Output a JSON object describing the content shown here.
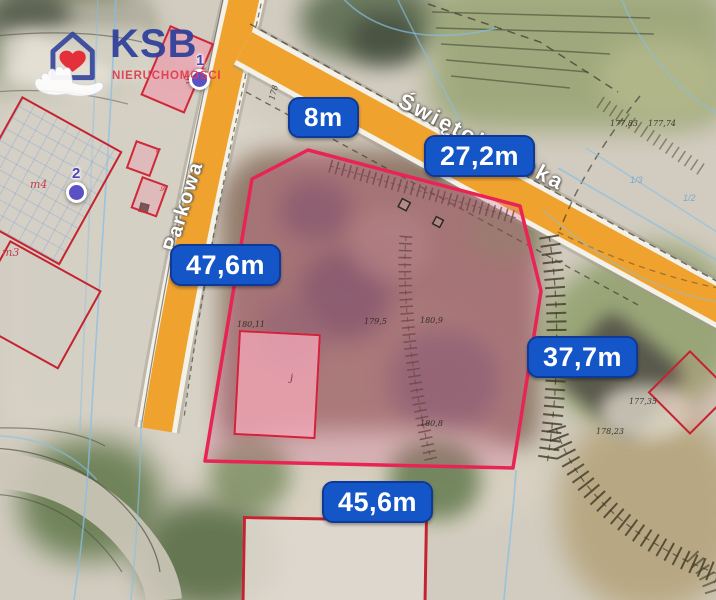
{
  "logo": {
    "brand": "KSB",
    "subtitle": "NIERUCHOMOŚCI"
  },
  "streets": {
    "left": "Parkowa",
    "top": "Świętokrzyska"
  },
  "measurements": [
    {
      "id": "north-west",
      "label": "8m"
    },
    {
      "id": "north",
      "label": "27,2m"
    },
    {
      "id": "west",
      "label": "47,6m"
    },
    {
      "id": "east",
      "label": "37,7m"
    },
    {
      "id": "south",
      "label": "45,6m"
    }
  ],
  "markers": [
    {
      "number": "1"
    },
    {
      "number": "2"
    }
  ],
  "parcel_labels": [
    {
      "text": "m"
    },
    {
      "text": "8"
    },
    {
      "text": "9"
    },
    {
      "text": "m4"
    },
    {
      "text": "m3"
    },
    {
      "text": "j"
    }
  ],
  "elevations": [
    {
      "text": "177,83"
    },
    {
      "text": "177,74"
    },
    {
      "text": "178"
    },
    {
      "text": "179,5"
    },
    {
      "text": "180,9"
    },
    {
      "text": "180,11"
    },
    {
      "text": "180,8"
    },
    {
      "text": "178,23"
    },
    {
      "text": "177,35"
    }
  ],
  "utility_labels": [
    {
      "text": "1/3"
    },
    {
      "text": "1/2"
    }
  ],
  "colors": {
    "badge_blue": "#1456c8",
    "road_orange": "#f0a22f",
    "parcel_outline": "#e82455",
    "logo_blue": "#2e3f9b",
    "logo_red": "#e23a4e",
    "marker_purple": "#5b50c4"
  }
}
